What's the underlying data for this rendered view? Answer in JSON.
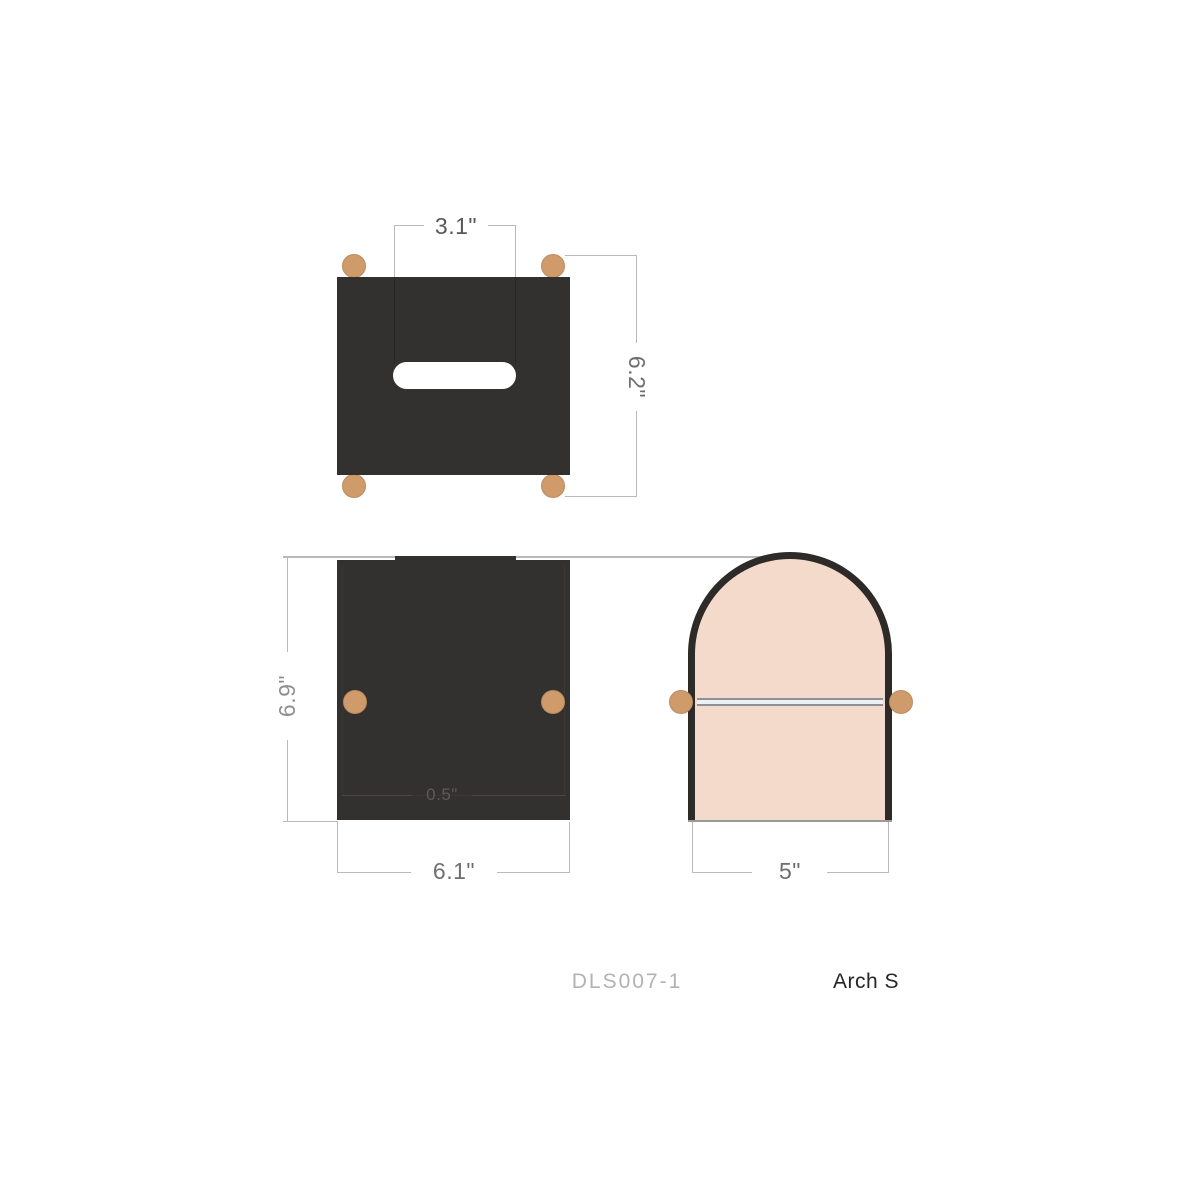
{
  "drawing": {
    "sku": "DLS007-1",
    "product_name": "Arch S",
    "dimensions": {
      "slot_width": "3.1\"",
      "top_depth": "6.2\"",
      "front_height": "6.9\"",
      "front_width": "6.1\"",
      "foot_clearance": "0.5\"",
      "side_width": "5\""
    },
    "colors": {
      "body": "#333130",
      "knob": "#cf9b6a",
      "arch_fill": "#f4daca",
      "arch_outline": "#2e2a27",
      "seam_line": "#8c919a",
      "dimension_line": "#b9b9b9",
      "dimension_text": "#6e6e6e",
      "sku_text": "#b2b2b2",
      "product_name_text": "#262626"
    }
  }
}
